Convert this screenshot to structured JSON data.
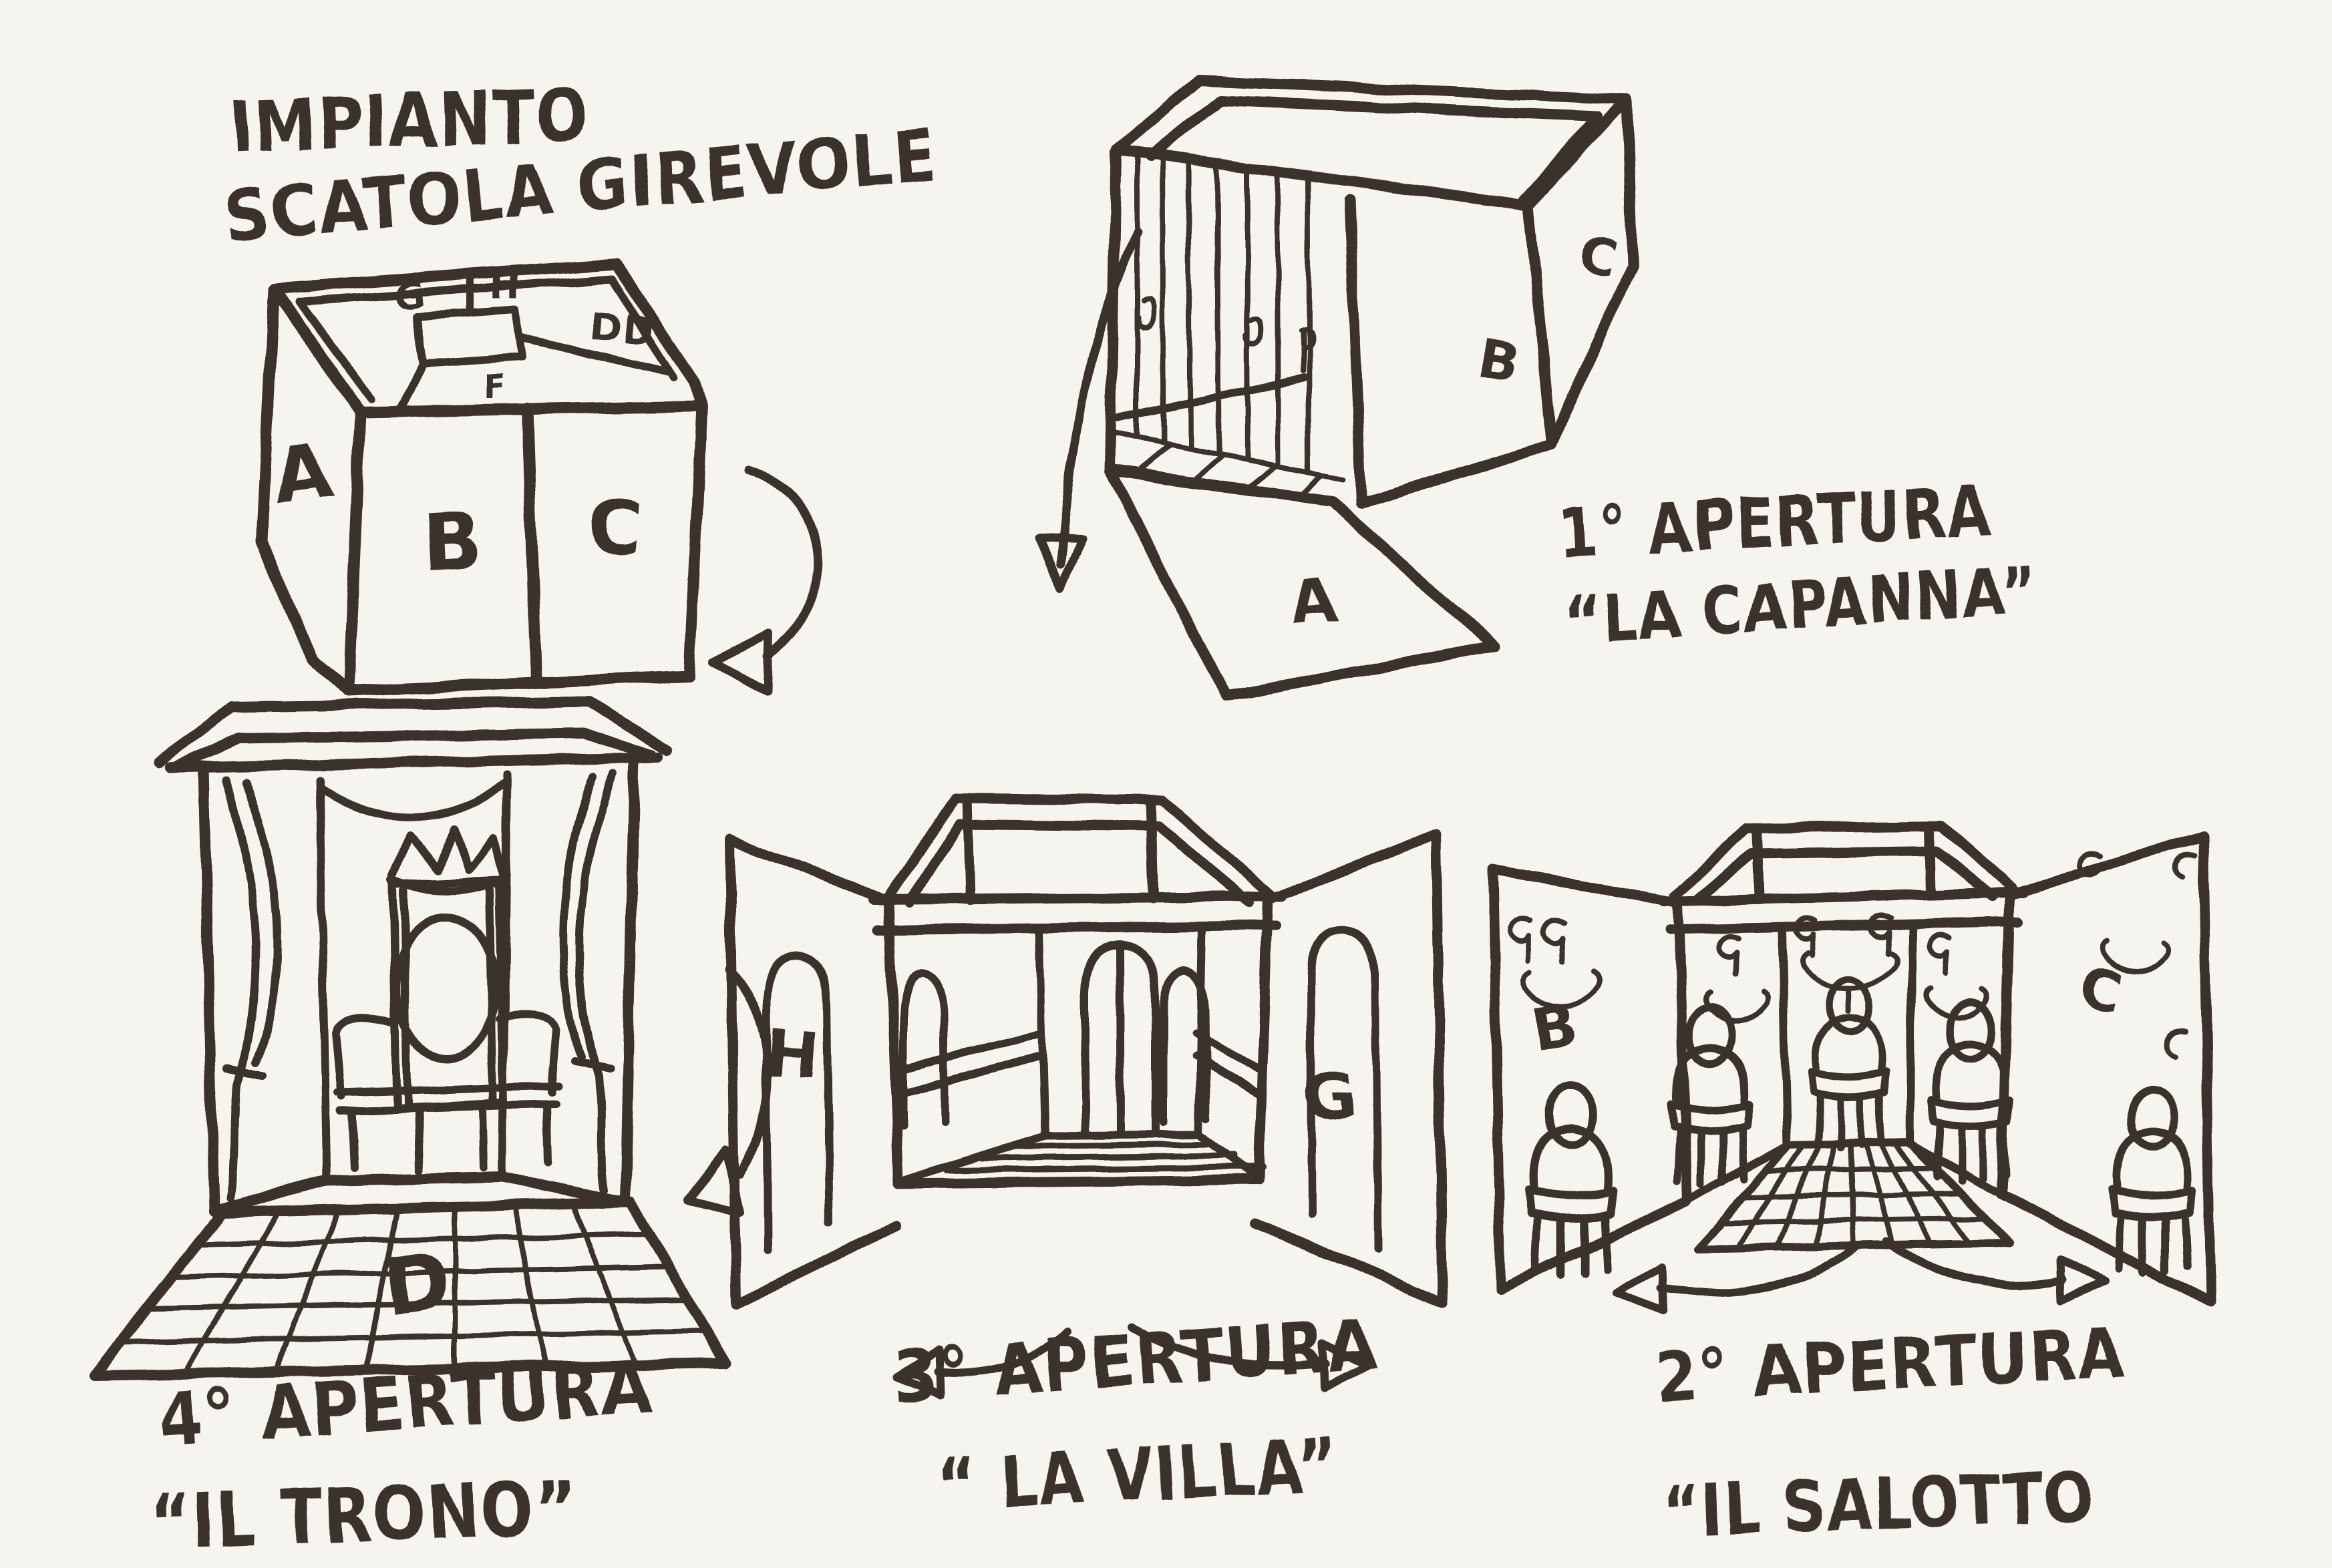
{
  "colors": {
    "paper": "#f6f4ef",
    "ink": "#3a312d"
  },
  "title": {
    "line1": "IMPIANTO",
    "line2": "SCATOLA GIREVOLE"
  },
  "closed_box": {
    "face_a": "A",
    "face_b": "B",
    "face_c": "C",
    "top_g": "G",
    "top_h": "H",
    "top_dd": "DD",
    "top_f": "F"
  },
  "apertura_1": {
    "number": "1° APERTURA",
    "name": "“LA CAPANNA”",
    "floor_panel": "A",
    "side_wall": "B",
    "end_wall": "C"
  },
  "apertura_2": {
    "number": "2° APERTURA",
    "name": "“IL SALOTTO",
    "left_panel": "B",
    "right_panel": "C"
  },
  "apertura_3": {
    "number": "3° APERTURA",
    "name": "“ LA VILLA”",
    "left_panel": "H",
    "right_panel": "G"
  },
  "apertura_4": {
    "number": "4° APERTURA",
    "name": "“IL TRONO”",
    "floor": "D"
  }
}
